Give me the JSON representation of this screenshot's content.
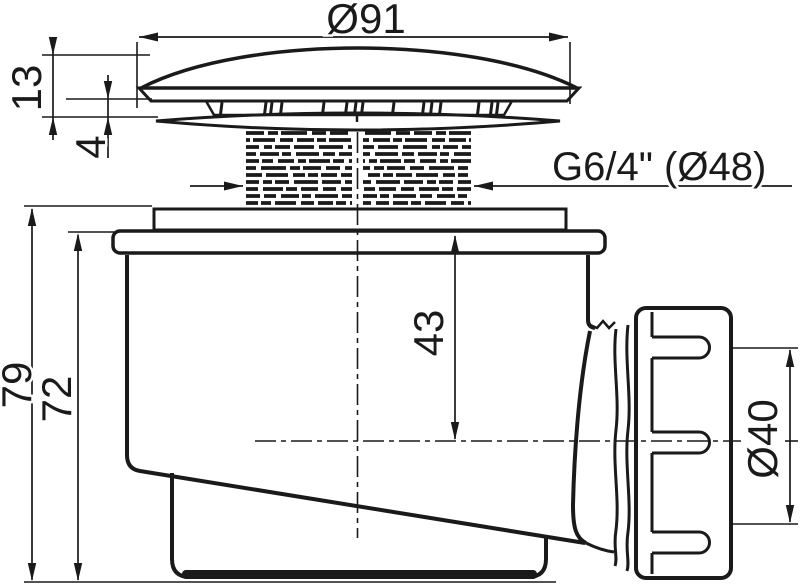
{
  "colors": {
    "line": "#1a1a1a",
    "background": "#ffffff",
    "cap_fill": "#a8a8a8",
    "band_fill": "#9e9e9e"
  },
  "dimensions": {
    "cap_diameter": "Ø91",
    "cap_height": "13",
    "cap_gap": "4",
    "thread_size": "G6/4\" (Ø48)",
    "depth_to_axis": "43",
    "total_height": "79",
    "body_height": "72",
    "outlet_diameter": "Ø40"
  }
}
